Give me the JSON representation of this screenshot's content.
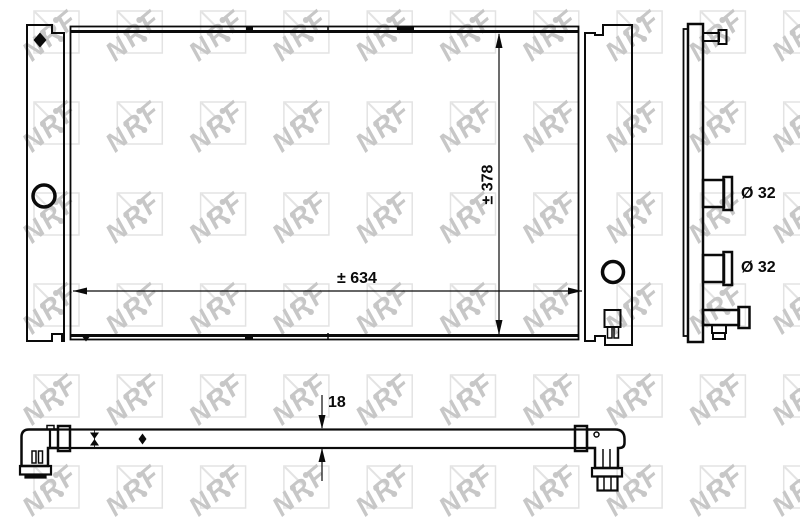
{
  "watermark": {
    "text": "NRF",
    "letter_color": "#c7c7c7",
    "box_color": "#e3e3e3"
  },
  "labels": {
    "core_width": "± 634",
    "core_height": "± 378",
    "core_thickness": "18",
    "top_port_diameter": "Ø 32",
    "bottom_port_diameter": "Ø 32"
  },
  "colors": {
    "line": "#0a0a0a",
    "background": "#ffffff"
  }
}
